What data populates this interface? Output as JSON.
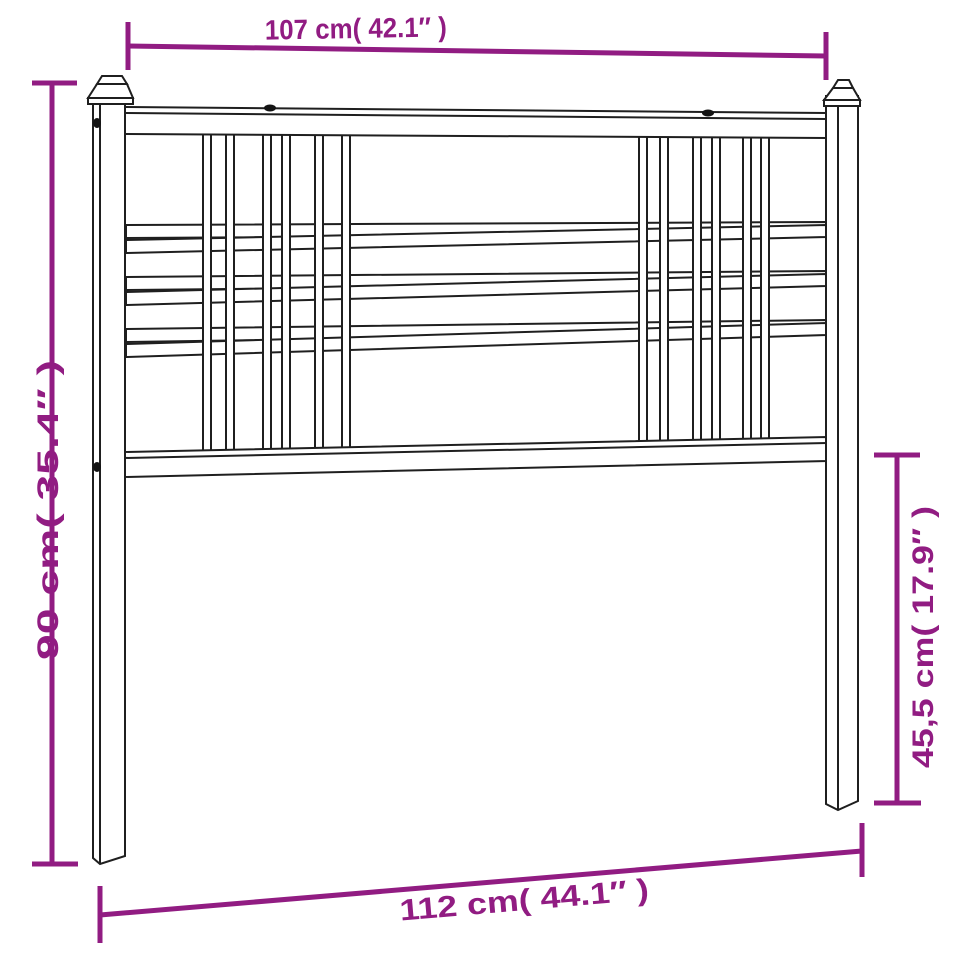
{
  "diagram": {
    "title": "Metal headboard dimension drawing",
    "colors": {
      "dimension_accent": "#911c82",
      "line_art": "#1f1f1f",
      "background": "#ffffff"
    },
    "dimensions": {
      "top": "107 cm( 42.1″ )",
      "left": "90 cm( 35.4″ )",
      "right": "45,5 cm( 17.9″ )",
      "bottom": "112 cm( 44.1″ )"
    }
  }
}
